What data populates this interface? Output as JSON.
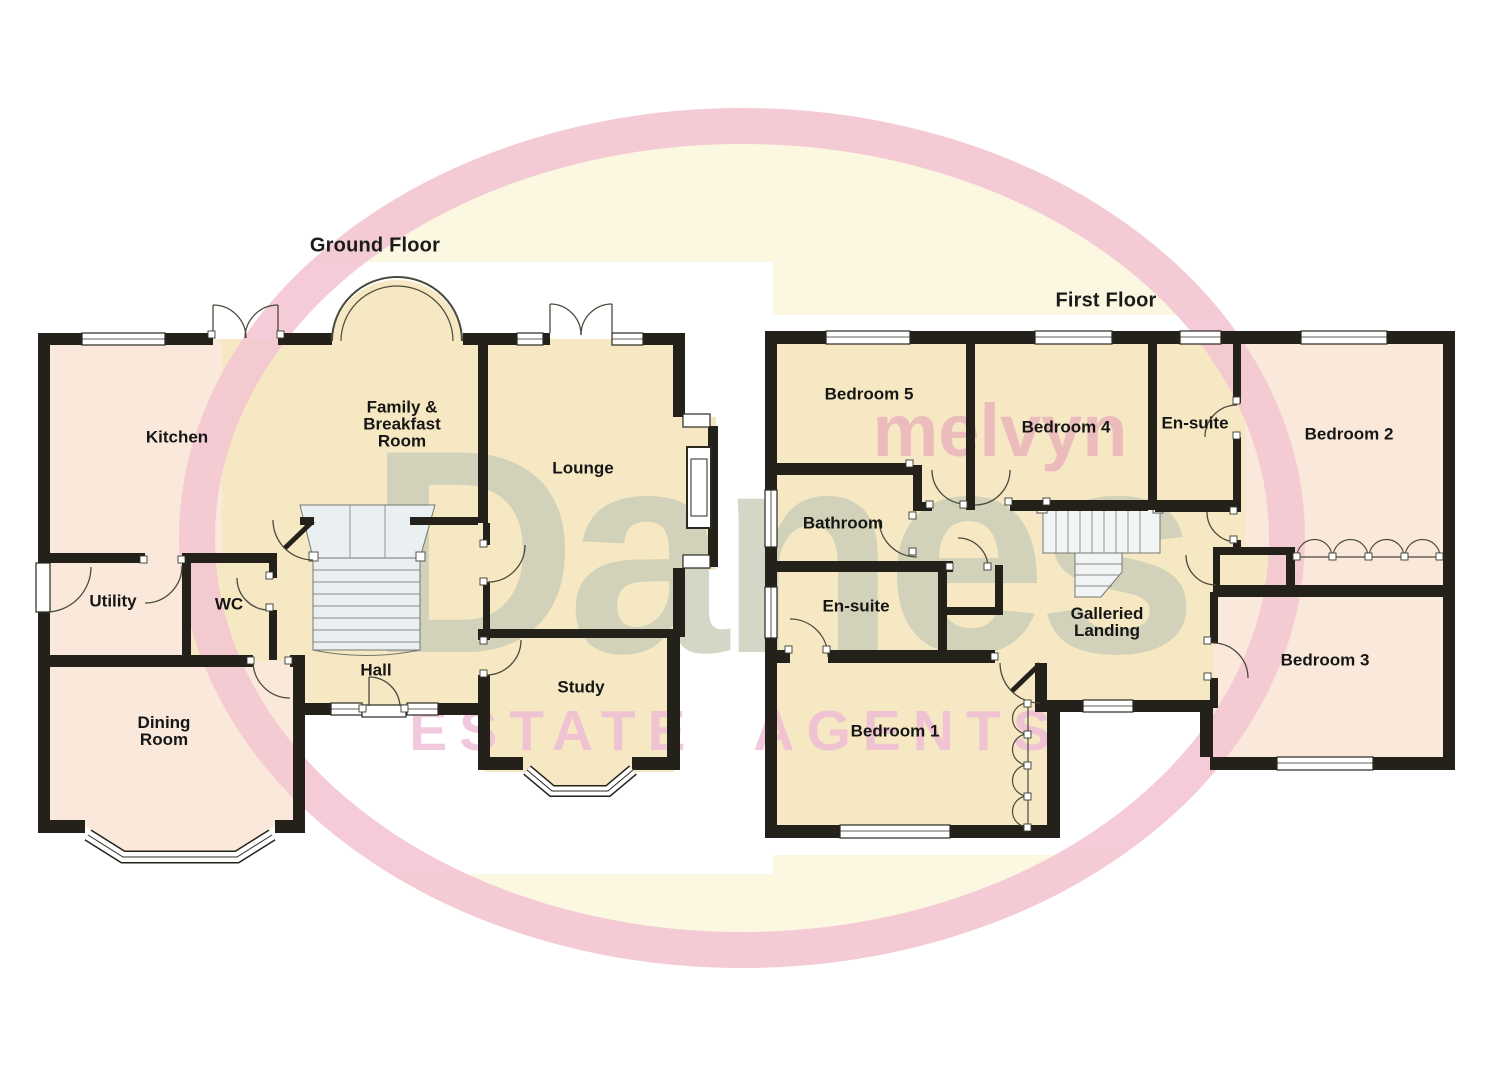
{
  "watermark": {
    "brand_first": "melvyn",
    "brand_last": "Danes",
    "brand_tagline": "ESTATE AGENTS"
  },
  "colors": {
    "wall": "#23211a",
    "room_warm_yellow": "#F5E8C2",
    "room_peach": "#FAE9DA",
    "ellipse_cream": "#FBF7E1",
    "ring_pink": "#F3C7D3",
    "big_letters_sage": "#C8CDB7",
    "melvyn_pink": "#E58FB8",
    "tagline_pink": "#EFBBD6",
    "stair_fill": "#EAF0F2",
    "label_text": "#161616"
  },
  "floors": [
    {
      "title": "Ground Floor",
      "rooms": [
        {
          "id": "kitchen",
          "label": "Kitchen"
        },
        {
          "id": "family-breakfast",
          "label": "Family &\nBreakfast\nRoom"
        },
        {
          "id": "lounge",
          "label": "Lounge"
        },
        {
          "id": "utility",
          "label": "Utility"
        },
        {
          "id": "wc",
          "label": "WC"
        },
        {
          "id": "hall",
          "label": "Hall"
        },
        {
          "id": "dining",
          "label": "Dining\nRoom"
        },
        {
          "id": "study",
          "label": "Study"
        }
      ]
    },
    {
      "title": "First Floor",
      "rooms": [
        {
          "id": "bedroom5",
          "label": "Bedroom 5"
        },
        {
          "id": "bedroom4",
          "label": "Bedroom 4"
        },
        {
          "id": "ensuite-top",
          "label": "En-suite"
        },
        {
          "id": "bedroom2",
          "label": "Bedroom 2"
        },
        {
          "id": "bathroom",
          "label": "Bathroom"
        },
        {
          "id": "ensuite",
          "label": "En-suite"
        },
        {
          "id": "galleried-landing",
          "label": "Galleried\nLanding"
        },
        {
          "id": "bedroom1",
          "label": "Bedroom 1"
        },
        {
          "id": "bedroom3",
          "label": "Bedroom 3"
        }
      ]
    }
  ]
}
